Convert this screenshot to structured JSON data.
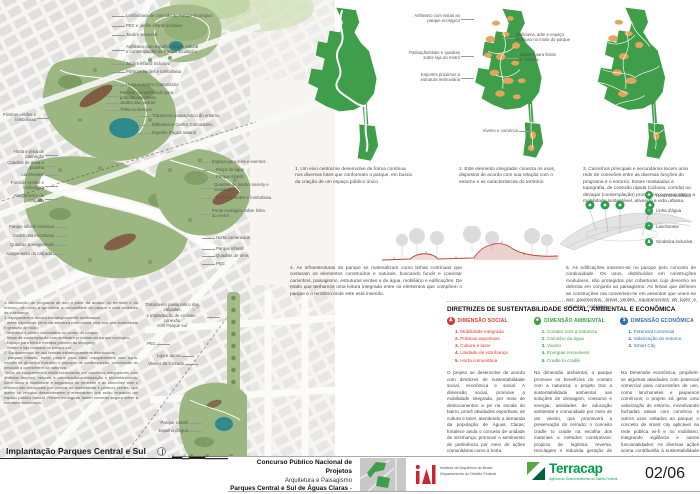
{
  "map": {
    "title": "Implantação Parques Central e Sul",
    "scale_ticks": [
      {
        "label": "0",
        "x": 0
      },
      {
        "label": "10",
        "x": 10
      },
      {
        "label": "15",
        "x": 17
      },
      {
        "label": "30",
        "x": 33
      },
      {
        "label": "50",
        "x": 57
      }
    ]
  },
  "program": {
    "text": "A distribuição do programa se deu a partir da análise do território e do entorno, de modo a aproximar a comunidade do parque e criar unidades de vizinhança.\n1. equipamentos âncora estrategicamente localizados:\n- áreas esportivas perto da estrutura metroviária pela sua alta atratividade e geração de ruído;\n- biblioteca e centro comunitário no centro do parque;\n- Áreas de contemplação com anfiteatro próximas ao parque ecológico;\n- Espaço para feira e eventos próximo ao shopping;\n- Viveiro e loja botânica no parque sul.\n2. Equipamentos de uso familiar estrategicamente distribuídos:\n- parques infantis, horta, parque para cães, equipamentos com água, circuito de ginástica inclusivo e espaços de contemplação, convidando as pessoas a conviverem na natureza.\nTodos os equipamentos estão conectados por caminhos integradores com distintas funções, velozes à caminhada/contemplação e bicicleta/corrida. Além disso a mobilidade e segurança do pedestre e as conexões com o entorno são reforçadas por: pontos de lombofaixas e pórticos verdes, que fazem os veículos desacelerarem e entenderem que estão cruzando um espaço público natural. Pontes ecológicas fazem conexão segura sobre a estrutura metroviária."
  },
  "captions": {
    "c1": "1. Um eixo central se desenvolve de forma contínua nos diversos lotes que conformam o parque, em busca da criação de um espaço público único",
    "c2": "2. Este elemento integrador conecta os usos, dispostos de acordo com sua relação com o entorno e as características do território",
    "c3": "3. Caminhos principais e secundários tecem uma rede de conexões entre as diversas funções do programa e o entorno. Esses modulados à topografia, de conexão rápida (ciclovia, corrida) ou devagar (contemplação) promovem o reencontro e a mobilidade sustentável, ativando a vida urbana.",
    "c4": "4. As infraestruturas do parque se materializam como linhas contínuas que costuram os elementos construídos e naturais, buscando fundir e conectar caminhos, paisagismo, estruturas verdes e de água, mobiliário e edificações. De modo que tenhamos uma leitura integrada entre os elementos que compõem o parque e o território onde este está inserido.",
    "c5": "5. As edificações inserem-se no parque pelo conceito de continuidade. Os usos, distribuídos em construções modulares, são protegidos por coberturas cujo desenho se delimita em conjunto ao paisagismo. As linhas que definem as construções ora convertem-se em assentos que unem-se aos pavimentos, áreas verdes, equipamentos de lazer e esportes, mobiliário."
  },
  "legend": {
    "items": [
      {
        "glyph": "♣",
        "label": "Horta comunitária"
      },
      {
        "glyph": "≈",
        "label": "Linha d'água"
      },
      {
        "glyph": "+",
        "label": "Lanchonete"
      },
      {
        "glyph": "♟",
        "label": "Ginástica inclusiva"
      }
    ]
  },
  "sustainability": {
    "heading": "DIRETRIZES DE SUSTENTABILIDADE SOCIAL, AMBIENTAL E ECONÔMICA",
    "dimensions": [
      {
        "title": "DIMENSÃO SOCIAL",
        "color": "#d93a2b",
        "glyph": "♟",
        "items": [
          "Mobilidade integrada",
          "Práticas esportivas",
          "Cultura e lazer",
          "Unidade de vizinhança",
          "Horta comunitária"
        ]
      },
      {
        "title": "DIMENSÃO AMBIENTAL",
        "color": "#3fa047",
        "glyph": "♣",
        "items": [
          "Contato com a natureza",
          "Caminho da água",
          "Viveiro",
          "Energias renováveis",
          "Cradle to cradle"
        ]
      },
      {
        "title": "DIMENSÃO ECONÔMICA",
        "color": "#2f6fb4",
        "glyph": "$",
        "items": [
          "Potencial comercial",
          "Valorização do entorno",
          "Smart City"
        ]
      }
    ],
    "paragraphs": [
      "O projeto se desenvolve de acordo com diretrizes de sustentabilidade social, econômica e social. A dimensão social, promove a mobilidade integrada, por meio de deslocamentos a pé na escala do bairro, provê atividades esportivas, de cultura e lazer, atendendo a demanda da população de Águas Claras; fortalece ainda o conceito de unidade de vizinhança; promove o sentimento de pertinência por meio de ações comunitárias como a horta.",
      "Na dimensão ambiental, o parque promove os benefícios do contato com a natureza; o projeto traz a sustentabilidade ambiental nas soluções de drenagem, consumo e energia; atividades de educação ambiental e comunidade por meio de um viveiro, que promoverá a preservação do cerrado; o conceito cradle to cradle na escolha dos materiais e métodos construtivos: propicia de logística reversa, reciclagem e reduzida geração de resíduos.",
      "Na Dimensão econômica, propõem-se algumas atividades com potencial comercial para concessões de uso, como lanchonetes e pequenos comércios; o projeto irá gerar uma valorização do entorno, incentivando fachadas ativas com comércio e outros usos voltados ao parque; o conceito de smart city aplicável na rede pública wi-fi e no mobiliário, integrando vigilância e outras funcionalidades; As diversas ações acima contribuirão à sustentabilidade econômica do parque."
    ]
  },
  "footer": {
    "line1": "Concurso Público Nacional de Projetos",
    "line2": "Arquitetura e Paisagismo",
    "line3_bold": "Parques Central e Sul de Águas Claras",
    "line3_suffix": " - DF",
    "iab_name": "Instituto de Arquitetos do Brasil",
    "iab_dept": "Departamento do Distrito Federal",
    "terracap_name": "Terracap",
    "terracap_tagline": "Agência de Desenvolvimento do Distrito Federal",
    "page": "02/06"
  },
  "annotations": [
    {
      "t": "Lombofaixa de conexão ao Parque Ecológico",
      "x": 126,
      "y": 13,
      "w": 92,
      "a": "left",
      "s": "l"
    },
    {
      "t": "PEC e jardim infantil inclusivo",
      "x": 126,
      "y": 23,
      "w": 80,
      "a": "left",
      "s": "l"
    },
    {
      "t": "Jardim sensorial",
      "x": 126,
      "y": 32,
      "w": 60,
      "a": "left",
      "s": "l"
    },
    {
      "t": "Anfiteatro com espelho d'água natural\ne contemplação do Parque Ecológico",
      "x": 126,
      "y": 44,
      "w": 92,
      "a": "left",
      "s": "l"
    },
    {
      "t": "Jardim infantil inclusivo",
      "x": 126,
      "y": 61,
      "w": 70,
      "a": "left",
      "s": "l"
    },
    {
      "t": "Pórticos verdes e lombofaixa",
      "x": 126,
      "y": 69,
      "w": 80,
      "a": "left",
      "s": "l"
    },
    {
      "t": "Horta e Centro Comunitário",
      "x": 126,
      "y": 82,
      "w": 80,
      "a": "left",
      "s": "l"
    },
    {
      "t": "Passeio compartilhado para\npráticas esportivas",
      "x": 120,
      "y": 90,
      "w": 70,
      "a": "left",
      "s": "l"
    },
    {
      "t": "Jardim das pedras",
      "x": 120,
      "y": 100,
      "w": 60,
      "a": "left",
      "s": "l"
    },
    {
      "t": "Trilha no bosque",
      "x": 120,
      "y": 107,
      "w": 60,
      "a": "left",
      "s": "l"
    },
    {
      "t": "Tratamento paisagístico do entorno",
      "x": 152,
      "y": 113,
      "w": 86,
      "a": "left",
      "s": "l"
    },
    {
      "t": "Biblioteca e Centro Comunitário",
      "x": 152,
      "y": 122,
      "w": 80,
      "a": "left",
      "s": "l"
    },
    {
      "t": "Espelho d'água natural",
      "x": 152,
      "y": 130,
      "w": 70,
      "a": "left",
      "s": "l"
    },
    {
      "t": "Pórticos verdes e lombofaixa",
      "x": 2,
      "y": 112,
      "w": 34,
      "a": "right",
      "s": "r"
    },
    {
      "t": "Horta e pista de patinação",
      "x": 2,
      "y": 149,
      "w": 42,
      "a": "right",
      "s": "r"
    },
    {
      "t": "Quadras de areia e prainha",
      "x": 4,
      "y": 160,
      "w": 40,
      "a": "right",
      "s": "r"
    },
    {
      "t": "Lanchonete",
      "x": 8,
      "y": 172,
      "w": 36,
      "a": "right",
      "s": "r"
    },
    {
      "t": "Pórticos verdes e lombofaixa",
      "x": 2,
      "y": 180,
      "w": 42,
      "a": "right",
      "s": "r"
    },
    {
      "t": "Alargamento da calçada",
      "x": 4,
      "y": 193,
      "w": 40,
      "a": "right",
      "s": "r"
    },
    {
      "t": "Parque infantil inclusivo",
      "x": 2,
      "y": 224,
      "w": 52,
      "a": "right",
      "s": "r"
    },
    {
      "t": "Jardim das esculturas",
      "x": 4,
      "y": 233,
      "w": 50,
      "a": "right",
      "s": "r"
    },
    {
      "t": "Quadras poliesportivas",
      "x": 2,
      "y": 242,
      "w": 52,
      "a": "right",
      "s": "r"
    },
    {
      "t": "Alargamento da calçada",
      "x": 0,
      "y": 251,
      "w": 52,
      "a": "right",
      "s": "r"
    },
    {
      "t": "Espaço para feira e eventos",
      "x": 212,
      "y": 159,
      "w": 72,
      "a": "left",
      "s": "l"
    },
    {
      "t": "Praça da água",
      "x": 216,
      "y": 167,
      "w": 50,
      "a": "left",
      "s": "l"
    },
    {
      "t": "Parque infantil",
      "x": 216,
      "y": 174,
      "w": 50,
      "a": "left",
      "s": "l"
    },
    {
      "t": "Quadras de futebol society e\nvestiários",
      "x": 214,
      "y": 182,
      "w": 78,
      "a": "left",
      "s": "l"
    },
    {
      "t": "Pórticos verdes e lombofaixa",
      "x": 216,
      "y": 195,
      "w": 76,
      "a": "left",
      "s": "l"
    },
    {
      "t": "Ponte ecológica sobre linha\ndo metrô",
      "x": 212,
      "y": 208,
      "w": 70,
      "a": "left",
      "s": "l"
    },
    {
      "t": "Horta comunitária",
      "x": 216,
      "y": 235,
      "w": 55,
      "a": "left",
      "s": "l"
    },
    {
      "t": "Parque infantil",
      "x": 216,
      "y": 246,
      "w": 50,
      "a": "left",
      "s": "l"
    },
    {
      "t": "Quadras de tênis",
      "x": 216,
      "y": 253,
      "w": 50,
      "a": "left",
      "s": "l"
    },
    {
      "t": "PEC",
      "x": 216,
      "y": 261,
      "w": 30,
      "a": "left",
      "s": "l"
    },
    {
      "t": "Tratamento paisagístico das calçadas\ne implantação de ciclovia - conexão\ncom Parque sul",
      "x": 138,
      "y": 302,
      "w": 68,
      "a": "center",
      "s": "r"
    },
    {
      "t": "PEC",
      "x": 130,
      "y": 341,
      "w": 26,
      "a": "right",
      "s": "r"
    },
    {
      "t": "Loja e apoio",
      "x": 140,
      "y": 353,
      "w": 40,
      "a": "right",
      "s": "r"
    },
    {
      "t": "Viveiro do Cerrado",
      "x": 136,
      "y": 361,
      "w": 48,
      "a": "right",
      "s": "r"
    },
    {
      "t": "Parque infantil",
      "x": 144,
      "y": 420,
      "w": 44,
      "a": "right",
      "s": "r"
    },
    {
      "t": "Espelho d'água",
      "x": 142,
      "y": 428,
      "w": 46,
      "a": "right",
      "s": "r"
    },
    {
      "t": "R. Ipê",
      "x": 191,
      "y": 303,
      "w": 20,
      "a": "left",
      "s": "n",
      "cls": "street",
      "rot": -35
    },
    {
      "t": "R. Acácia",
      "x": 198,
      "y": 437,
      "w": 24,
      "a": "left",
      "s": "n",
      "cls": "street",
      "rot": -35
    },
    {
      "t": "Anfiteatro com vistas ao\nparque ecológico",
      "x": 398,
      "y": 13,
      "w": 62,
      "a": "right",
      "s": "r",
      "n": "diagram-callout"
    },
    {
      "t": "Patinação/skate e quadras\nsobre laje do metrô",
      "x": 394,
      "y": 50,
      "w": 66,
      "a": "right",
      "s": "r",
      "n": "diagram-callout"
    },
    {
      "t": "Esportes próximos a\nestrutura metroviária",
      "x": 400,
      "y": 72,
      "w": 60,
      "a": "right",
      "s": "r",
      "n": "diagram-callout"
    },
    {
      "t": "Biblioteca, adm e espaço\nmultiuso no miolo do parque",
      "x": 516,
      "y": 32,
      "w": 64,
      "a": "left",
      "s": "l",
      "n": "diagram-callout"
    },
    {
      "t": "Espaço para feiras\ne eventos",
      "x": 520,
      "y": 52,
      "w": 50,
      "a": "left",
      "s": "l",
      "n": "diagram-callout"
    },
    {
      "t": "Viveiro e comércio",
      "x": 474,
      "y": 128,
      "w": 44,
      "a": "right",
      "s": "r",
      "n": "diagram-callout"
    }
  ]
}
